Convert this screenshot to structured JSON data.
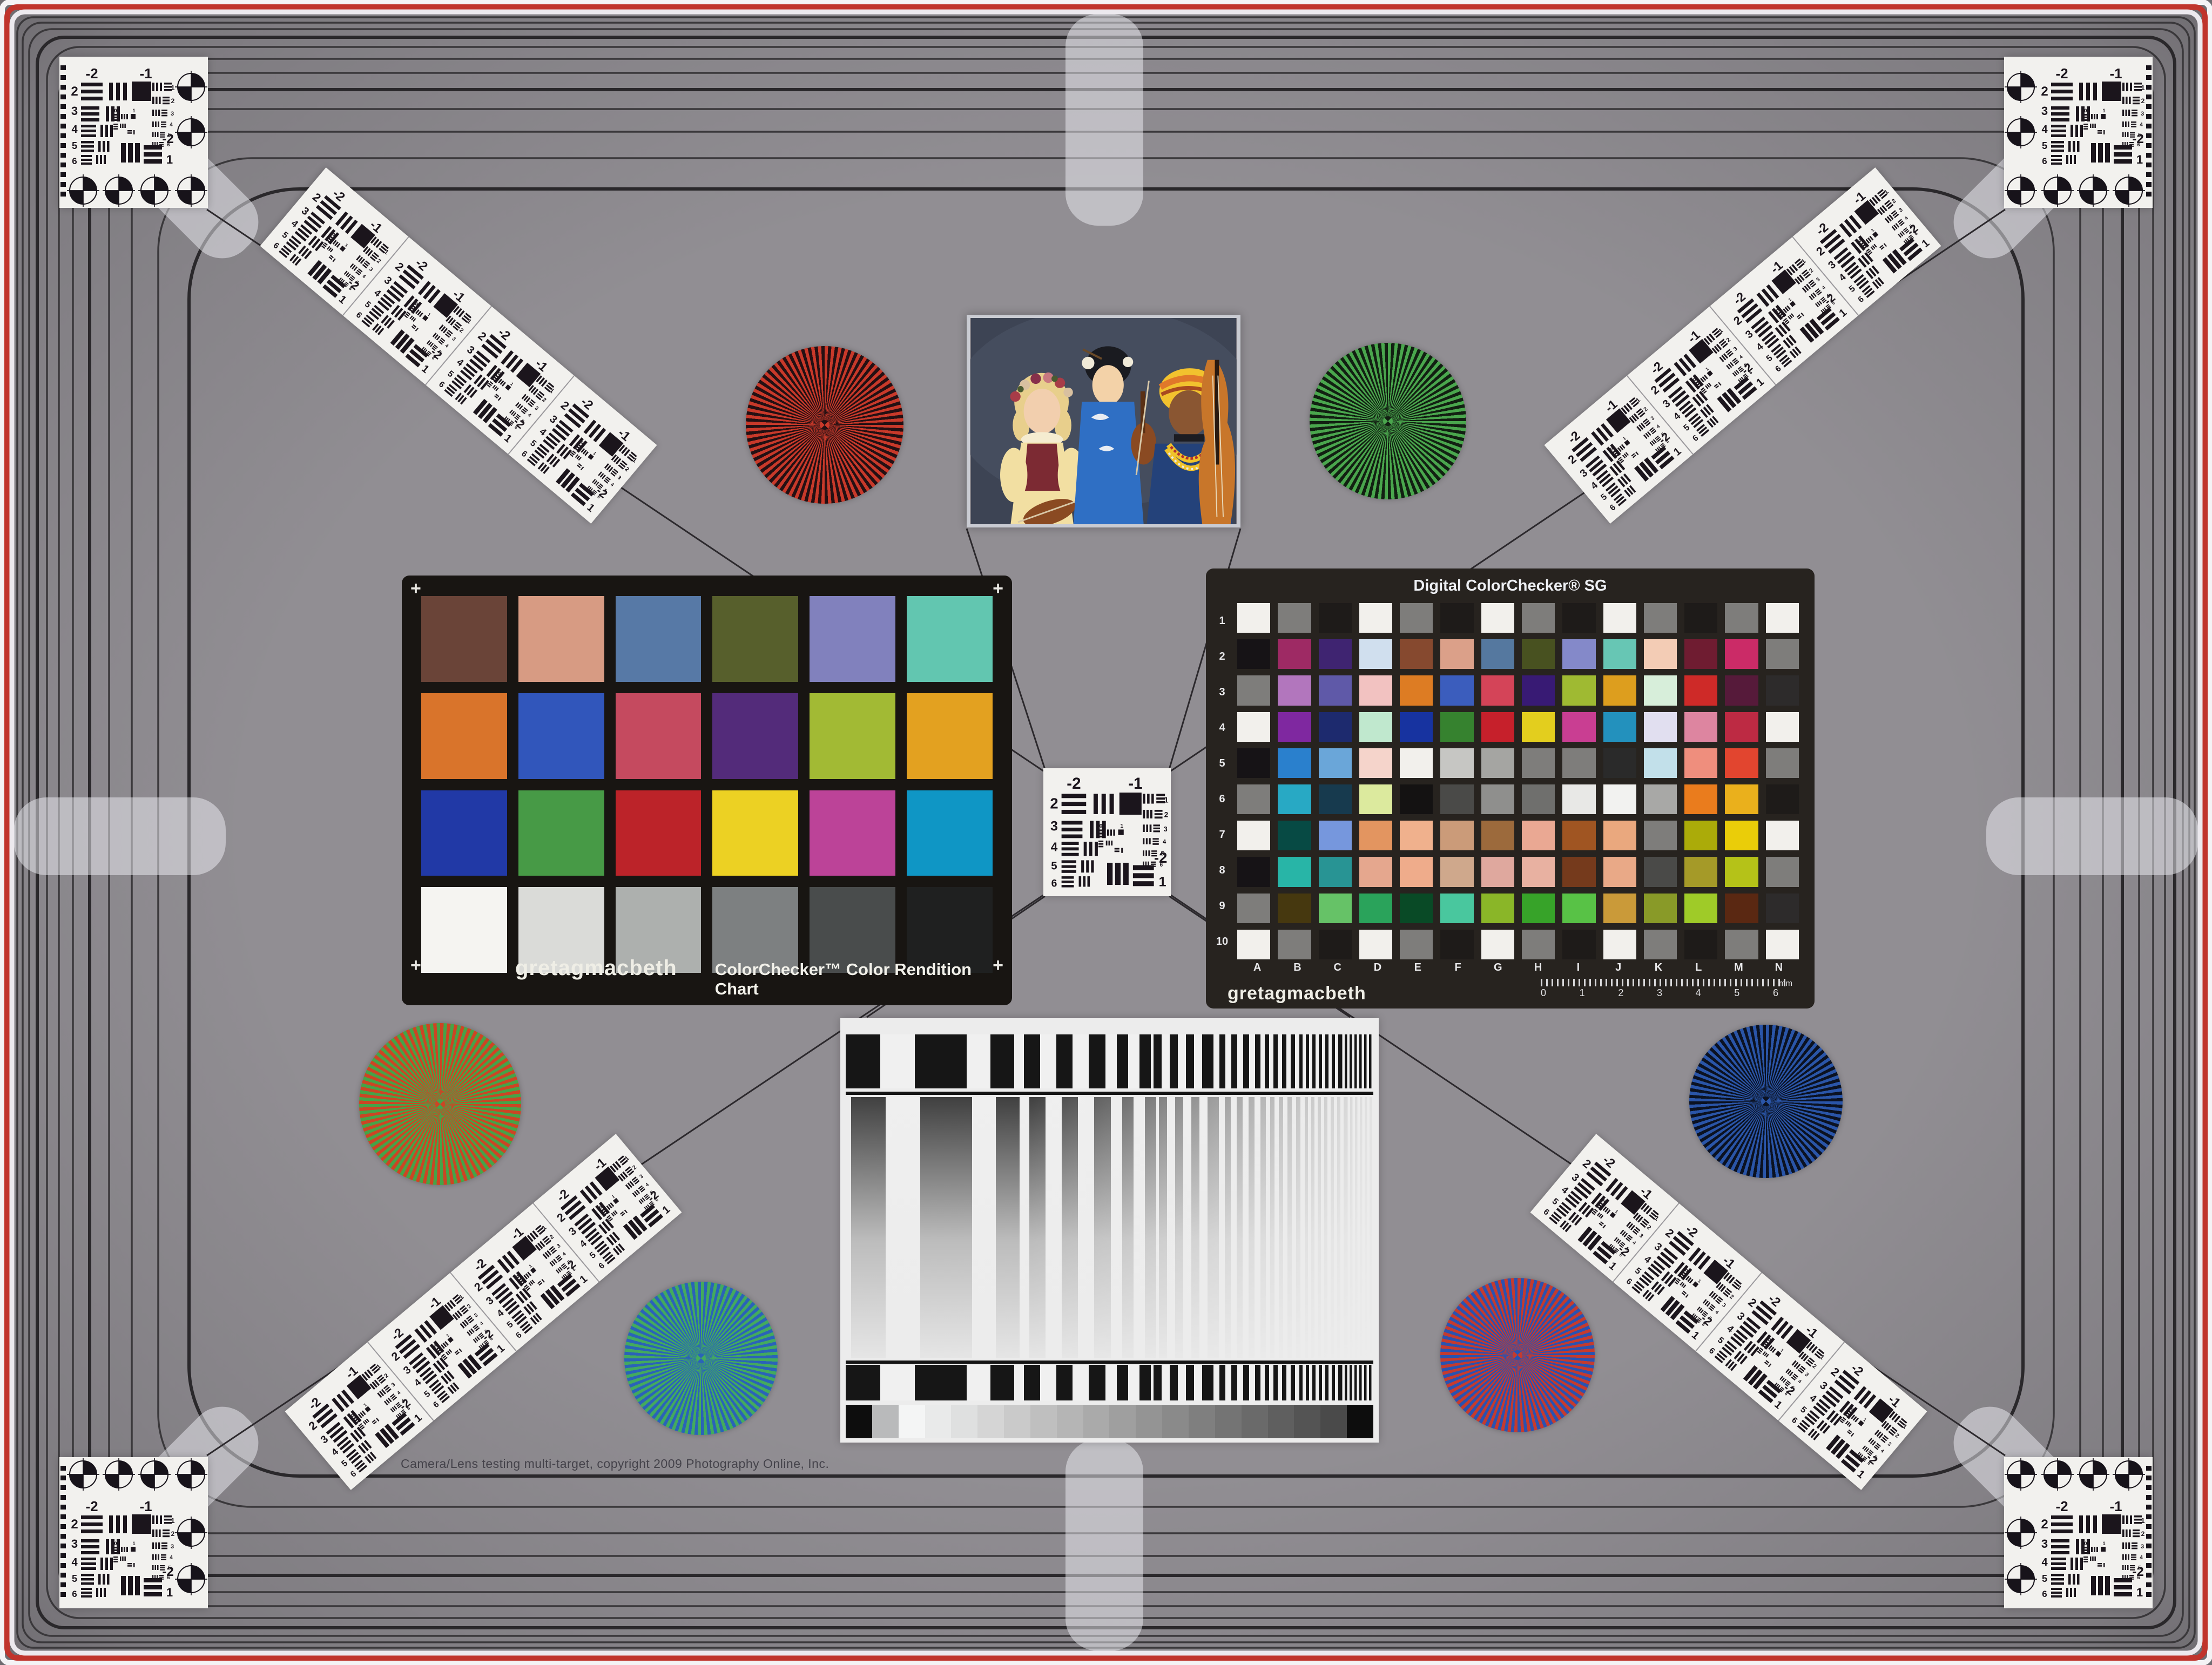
{
  "texts": {
    "copyright": "Camera/Lens testing multi-target, copyright 2009 Photography Online, Inc."
  },
  "colorchecker": {
    "brand": "gretagmacbeth",
    "title": "ColorChecker™ Color Rendition Chart",
    "plus_mark": "+",
    "rows": [
      [
        "#6a4438",
        "#d79b83",
        "#5779a6",
        "#575f2c",
        "#8181bd",
        "#62c6b0"
      ],
      [
        "#d9742b",
        "#3156bb",
        "#c54a5f",
        "#532b7a",
        "#a2ba34",
        "#e3a120"
      ],
      [
        "#2139a6",
        "#479a46",
        "#bc2329",
        "#ecd123",
        "#bc4398",
        "#0f96c5"
      ],
      [
        "#f5f4f1",
        "#dadbd8",
        "#adb0ae",
        "#7d8081",
        "#494c4c",
        "#1f2020"
      ]
    ]
  },
  "sg": {
    "title": "Digital ColorChecker® SG",
    "brand": "gretagmacbeth",
    "row_labels": [
      "1",
      "2",
      "3",
      "4",
      "5",
      "6",
      "7",
      "8",
      "9",
      "10"
    ],
    "col_labels": [
      "A",
      "B",
      "C",
      "D",
      "E",
      "F",
      "G",
      "H",
      "I",
      "J",
      "K",
      "L",
      "M",
      "N"
    ],
    "ruler_numbers": [
      "0",
      "1",
      "2",
      "3",
      "4",
      "5",
      "6"
    ],
    "ruler_unit": "mm",
    "rows": [
      [
        "#f2f0ec",
        "#7e7d7b",
        "#1e1b19",
        "#f2f0ec",
        "#7e7d7b",
        "#1e1b19",
        "#f2f0ec",
        "#7e7d7b",
        "#1e1b19",
        "#f2f0ec",
        "#7e7d7b",
        "#1e1b19",
        "#7e7d7b",
        "#f2f0ec"
      ],
      [
        "#161316",
        "#9e2a64",
        "#3f2471",
        "#d0dfee",
        "#86492f",
        "#dba089",
        "#55789f",
        "#485120",
        "#8489c9",
        "#67c6b4",
        "#f3ccb5",
        "#6f1c31",
        "#cb2b67",
        "#7e7d7b"
      ],
      [
        "#7e7d7b",
        "#b276bd",
        "#5f59a8",
        "#f2c2c1",
        "#dd7c23",
        "#3b5dbd",
        "#d44458",
        "#381a74",
        "#9fba32",
        "#dd9e1e",
        "#d7eeda",
        "#ce2a28",
        "#561a3a",
        "#2d2b2b"
      ],
      [
        "#f2f0ec",
        "#7f28a0",
        "#1d2a6e",
        "#c0e8ce",
        "#1733a0",
        "#36822f",
        "#c6202b",
        "#e3ce1e",
        "#c93e92",
        "#2391bd",
        "#e1dff0",
        "#dd85a0",
        "#bd2a43",
        "#f2f0ec"
      ],
      [
        "#161316",
        "#2a80cd",
        "#6aa6d9",
        "#f5d4cb",
        "#f2f0ec",
        "#c6c6c3",
        "#a5a5a2",
        "#7e7d7b",
        "#7e7d7b",
        "#2a2a2a",
        "#c2e0ea",
        "#ef8e7d",
        "#e2452f",
        "#7e7d7b"
      ],
      [
        "#7e7d7b",
        "#28a9c4",
        "#173a4e",
        "#dcea9e",
        "#141212",
        "#4a4a48",
        "#8f8f8d",
        "#6f6f6d",
        "#e8e8e6",
        "#f2f2f0",
        "#a8a8a6",
        "#ea7c1d",
        "#eab01c",
        "#1e1b19"
      ],
      [
        "#f2f0ec",
        "#074a44",
        "#7697dd",
        "#e39560",
        "#f0b18d",
        "#cb9b79",
        "#9c6a3c",
        "#eaa893",
        "#a05522",
        "#eaa87e",
        "#7e7d7b",
        "#abab09",
        "#eacd09",
        "#f2f0ec"
      ],
      [
        "#161316",
        "#28b5a7",
        "#289494",
        "#e5a78e",
        "#efac8b",
        "#cfa88c",
        "#dfa89e",
        "#e8b1a1",
        "#753a1c",
        "#e9a987",
        "#4a4a48",
        "#a59a28",
        "#b5c218",
        "#7e7d7b"
      ],
      [
        "#7e7d7b",
        "#46380f",
        "#66c267",
        "#2aa35b",
        "#094a26",
        "#49c79e",
        "#8ab628",
        "#37a329",
        "#58c246",
        "#ca9a39",
        "#899a28",
        "#9fcb28",
        "#5a2812",
        "#2d2b2b"
      ],
      [
        "#f2f0ec",
        "#7e7d7b",
        "#1e1b19",
        "#f2f0ec",
        "#7e7d7b",
        "#1e1b19",
        "#f2f0ec",
        "#7e7d7b",
        "#1e1b19",
        "#f2f0ec",
        "#7e7d7b",
        "#1e1b19",
        "#7e7d7b",
        "#f2f0ec"
      ]
    ]
  },
  "usaf": {
    "neg2": "-2",
    "neg1": "-1",
    "left": [
      "2",
      "3",
      "4",
      "5",
      "6"
    ],
    "right": [
      "1",
      "2",
      "3",
      "4",
      "5",
      "6"
    ],
    "corner": [
      "-2",
      "1"
    ],
    "mini": [
      "0",
      "1"
    ]
  },
  "starbursts": {
    "red_black": {
      "c1": "#c8392a",
      "c2": "#241013"
    },
    "green_black": {
      "c1": "#4aa64d",
      "c2": "#122012"
    },
    "red_green": {
      "c1": "#cc4524",
      "c2": "#46a348"
    },
    "blue_black": {
      "c1": "#2a55a8",
      "c2": "#0b1222"
    },
    "green_blue": {
      "c1": "#43aa5e",
      "c2": "#2a63b8"
    },
    "red_blue": {
      "c1": "#c43b2f",
      "c2": "#2a52b0"
    }
  },
  "sweep": {
    "grays": [
      "#0d0d0d",
      "#b9babb",
      "#f4f5f5",
      "#e9eaea",
      "#dfe0e0",
      "#d5d5d5",
      "#cacaca",
      "#bfbfbf",
      "#b5b5b5",
      "#aaaaaa",
      "#9f9f9f",
      "#949494",
      "#8a8a8a",
      "#7f7f7f",
      "#747474",
      "#6a6a6a",
      "#5f5f5f",
      "#545454",
      "#4a4a4a",
      "#0d0d0d"
    ]
  },
  "photo": {
    "backdrop": "#3d4454",
    "backdrop_light": "#4d5668",
    "hair_left": "#e8cf8c",
    "skin_left": "#f2cfae",
    "dress_left": "#f2dfa2",
    "vest_left": "#7c2a33",
    "collar_left": "#f5ecd0",
    "hair_middle": "#1a1b20",
    "skin_middle": "#f3d2a8",
    "kimono": "#2f6fc4",
    "violin": "#8a4a22",
    "turban_yellow": "#f2c22e",
    "turban_orange": "#e0782a",
    "skin_right": "#8a5632",
    "robe_right": "#24427a",
    "necklace": "#f0c22a",
    "cello": "#c8762a"
  },
  "frame_colors": {
    "red_ring": "#c0342c",
    "white_ring": "#ece9ee",
    "line_dark": "#3a383b"
  }
}
